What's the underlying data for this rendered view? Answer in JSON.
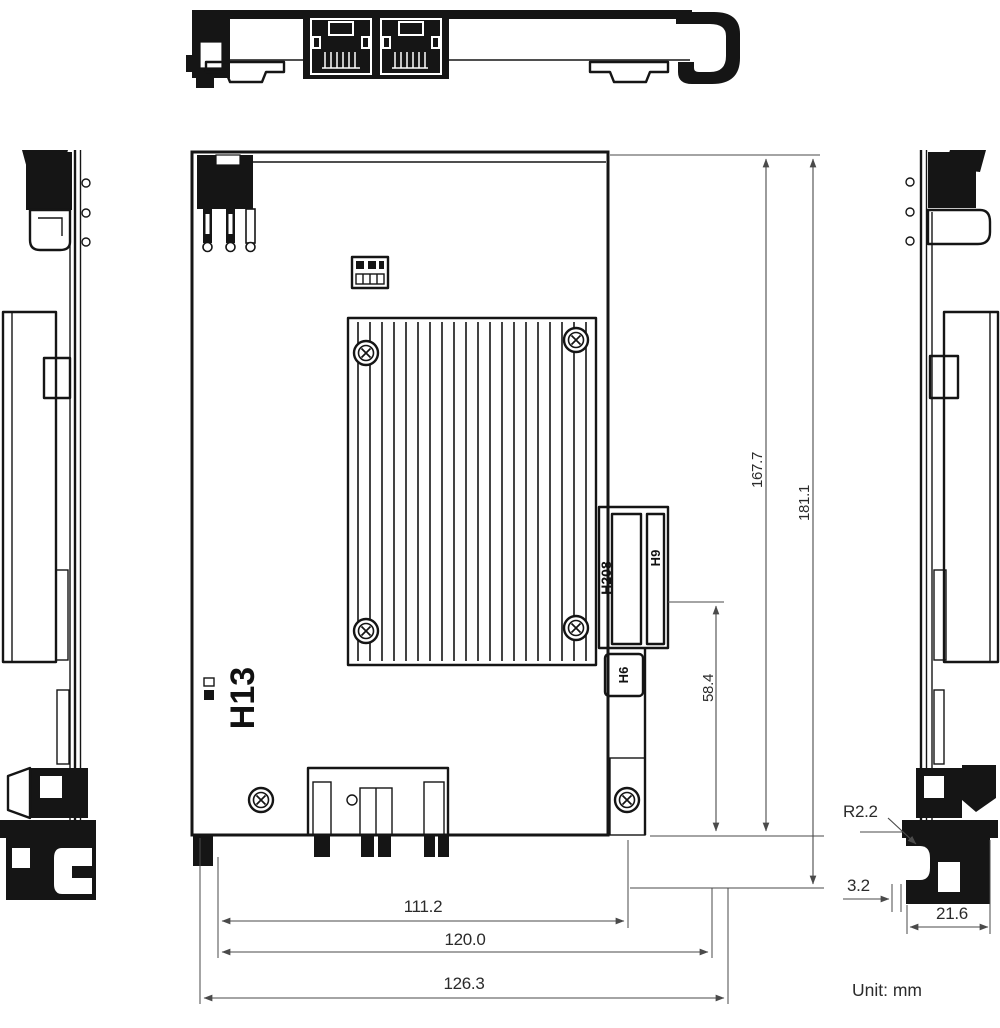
{
  "unit_note": "Unit: mm",
  "colors": {
    "background": "#ffffff",
    "ink": "#151515",
    "dimension_line": "#4a4a4a",
    "dimension_text": "#2b2b2b"
  },
  "labels": {
    "h13": "H13",
    "h208": "H208",
    "h9": "H9",
    "h6": "H6"
  },
  "dimensions": {
    "board_length": "167.7",
    "overall_length": "181.1",
    "connector_to_edge": "58.4",
    "width_inner": "111.2",
    "width_bracket": "120.0",
    "width_total": "126.3",
    "bracket_corner_radius": "R2.2",
    "bracket_tab_thickness": "3.2",
    "bracket_foot_width": "21.6"
  }
}
